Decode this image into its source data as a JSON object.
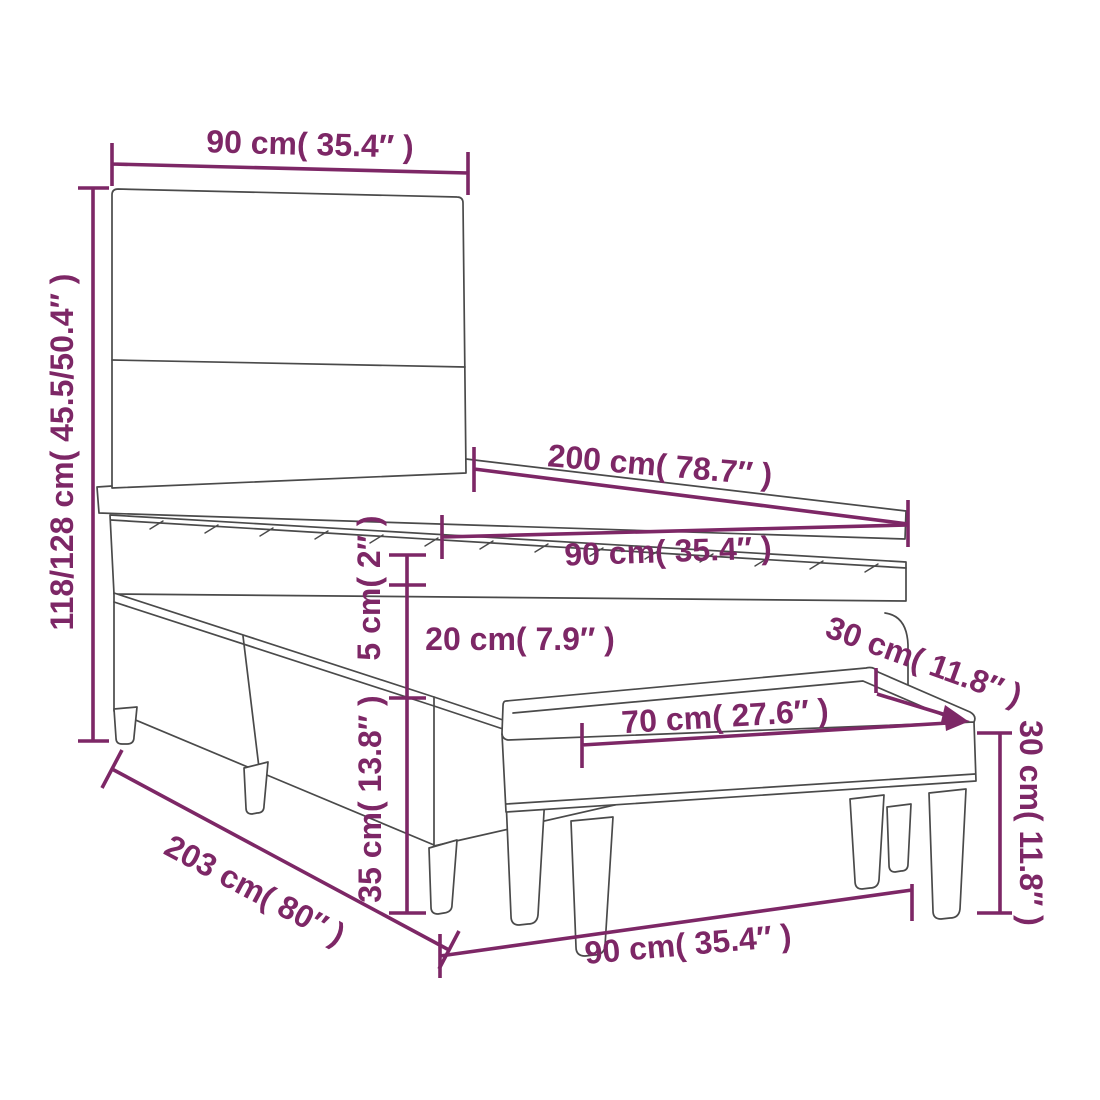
{
  "diagram": {
    "accent_color": "#7D2766",
    "line_color": "#4A4A4A",
    "background_color": "#FFFFFF",
    "dimensions": {
      "headboard_width": "90 cm( 35.4″ )",
      "headboard_height": "118/128 cm( 45.5/50.4″ )",
      "bed_length": "200 cm( 78.7″ )",
      "mattress_width": "90 cm( 35.4″ )",
      "topper_thickness": "5 cm( 2″ )",
      "mattress_thickness": "20 cm( 7.9″ )",
      "base_height": "35 cm( 13.8″ )",
      "total_floor_length": "203 cm( 80″ )",
      "bench_length": "70 cm( 27.6″ )",
      "bench_depth": "30 cm( 11.8″ )",
      "bench_height": "30 cm( 11.8″ )",
      "floor_width": "90 cm( 35.4″ )"
    }
  }
}
